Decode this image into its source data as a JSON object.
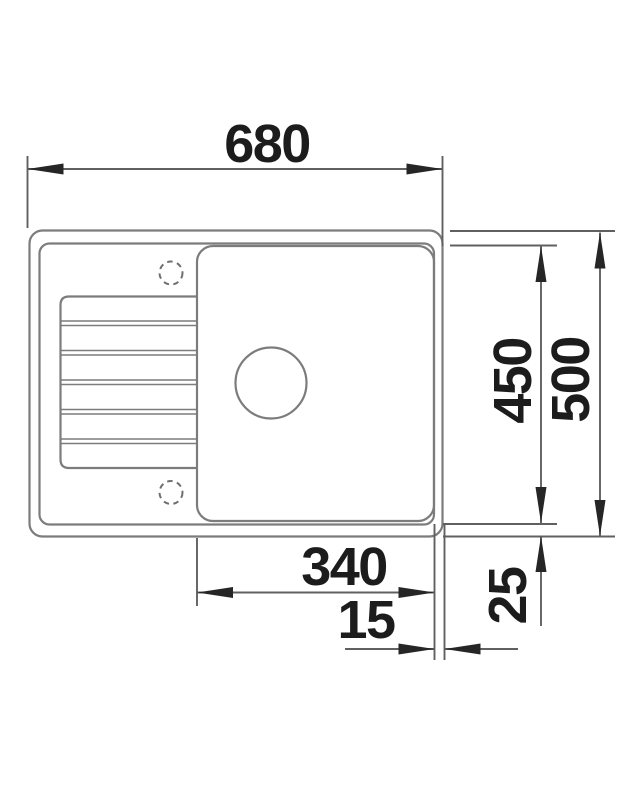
{
  "drawing": {
    "title": "sink-top-view-technical-drawing",
    "colors": {
      "background": "#ffffff",
      "sink_outline": "#7c7c7c",
      "dimension_line": "#606060",
      "arrowhead": "#262626",
      "label_text": "#1c1c1c"
    },
    "dimensions": {
      "overall_width": "680",
      "inner_depth": "450",
      "overall_depth": "500",
      "bowl_width": "340",
      "bowl_to_edge_gap": "15",
      "rim_width": "25"
    }
  }
}
